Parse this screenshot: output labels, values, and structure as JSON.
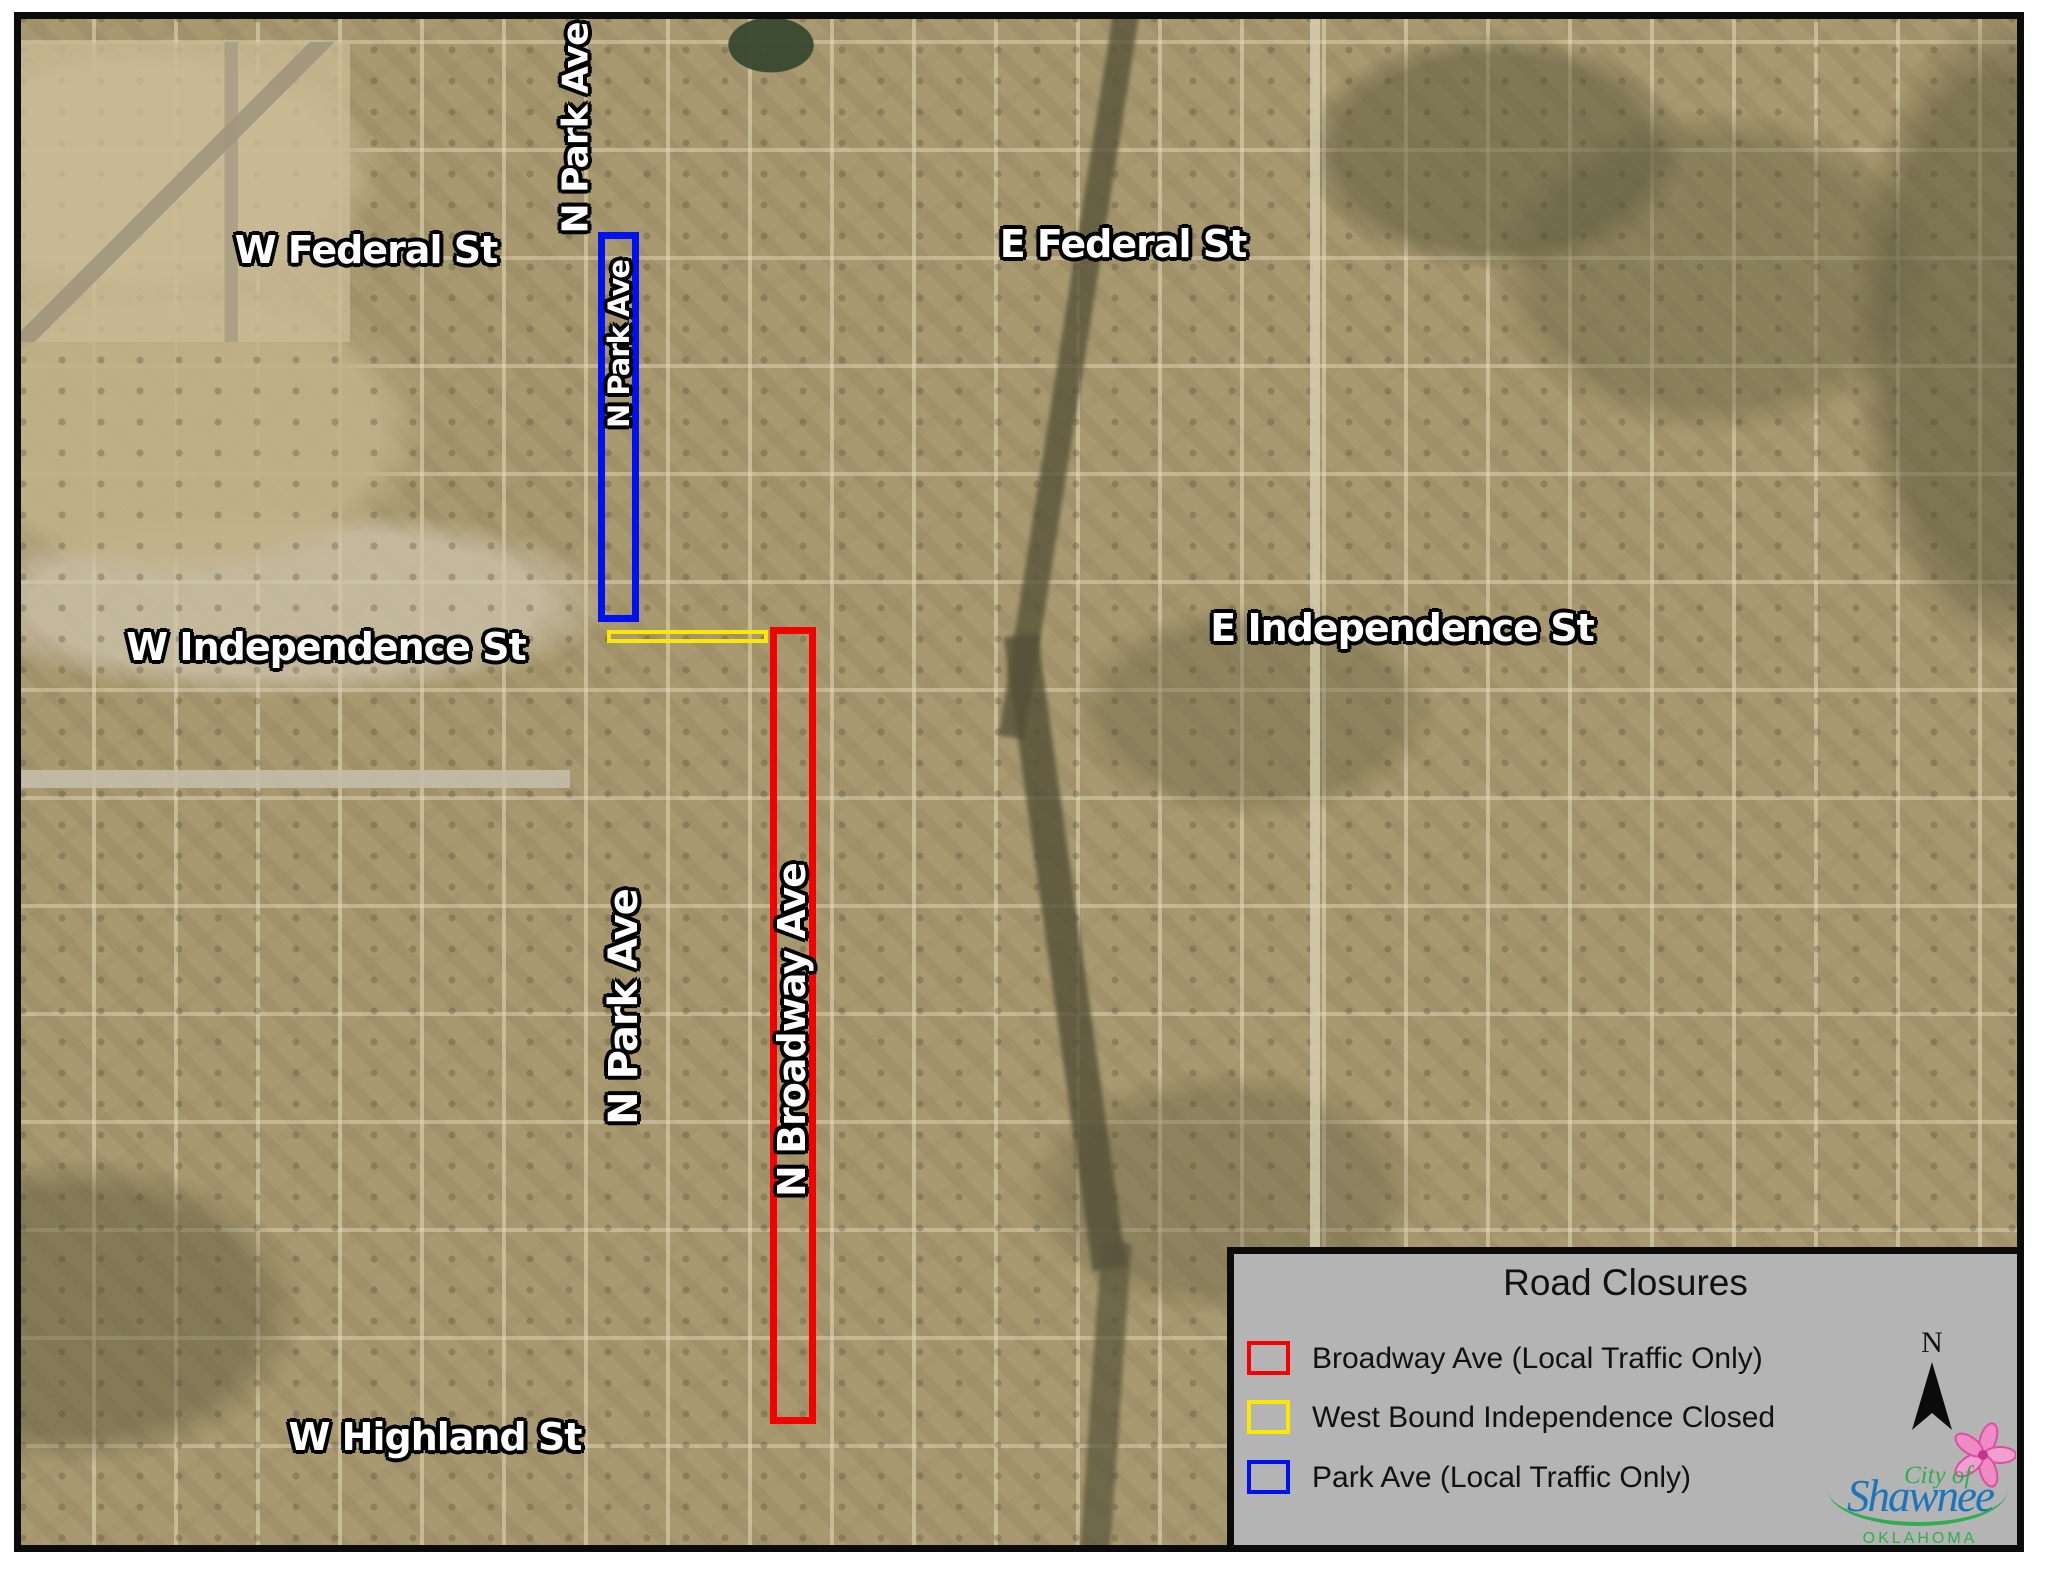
{
  "map": {
    "street_labels": [
      {
        "id": "park-ave-top",
        "text": "N Park Ave",
        "orientation": "vertical"
      },
      {
        "id": "w-federal",
        "text": "W Federal St",
        "orientation": "horizontal"
      },
      {
        "id": "e-federal",
        "text": "E Federal St",
        "orientation": "horizontal"
      },
      {
        "id": "park-ave-in-closure",
        "text": "N Park Ave",
        "orientation": "vertical"
      },
      {
        "id": "w-independence",
        "text": "W Independence St",
        "orientation": "horizontal"
      },
      {
        "id": "e-independence",
        "text": "E Independence St",
        "orientation": "horizontal"
      },
      {
        "id": "park-ave-south",
        "text": "N Park Ave",
        "orientation": "vertical"
      },
      {
        "id": "n-broadway",
        "text": "N Broadway Ave",
        "orientation": "vertical"
      },
      {
        "id": "w-highland",
        "text": "W Highland St",
        "orientation": "horizontal"
      }
    ],
    "closures": [
      {
        "name": "Broadway Ave closure",
        "color": "#f40000"
      },
      {
        "name": "West Bound Independence closure",
        "color": "#ffe800"
      },
      {
        "name": "Park Ave closure",
        "color": "#0010ee"
      }
    ]
  },
  "legend": {
    "title": "Road Closures",
    "background": "#b4b4b4",
    "north_label": "N",
    "items": [
      {
        "label": "Broadway Ave (Local Traffic Only)",
        "color": "#f40000"
      },
      {
        "label": "West Bound Independence Closed",
        "color": "#ffe800"
      },
      {
        "label": "Park Ave (Local Traffic Only)",
        "color": "#0010ee"
      }
    ]
  },
  "logo": {
    "line1": "City of",
    "line2": "Shawnee",
    "line3": "OKLAHOMA",
    "colors": {
      "green": "#2fae4f",
      "blue": "#1c75bc",
      "pink": "#ef8ac6"
    }
  }
}
